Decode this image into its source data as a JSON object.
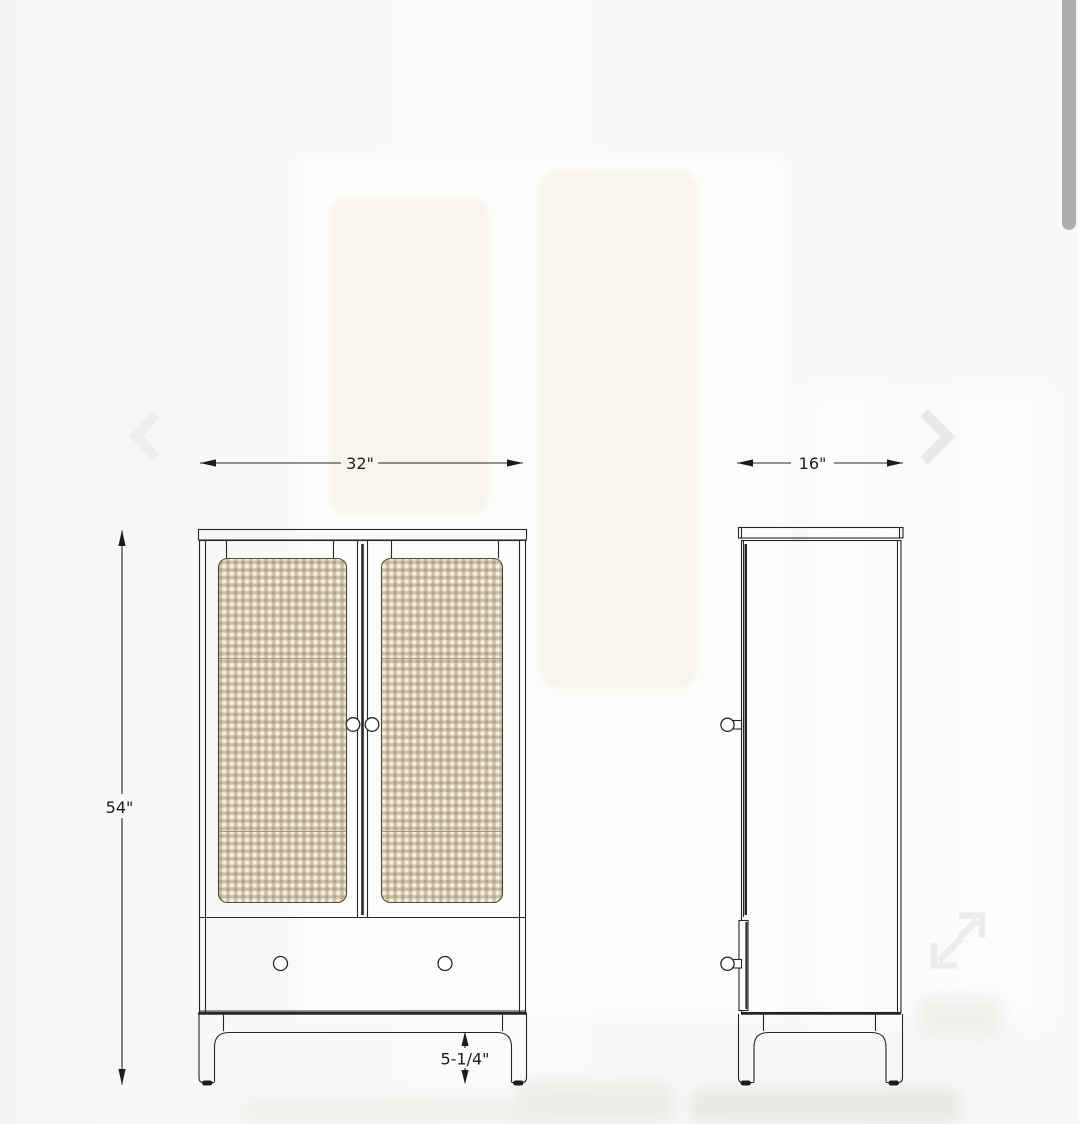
{
  "viewer": {
    "controls": {
      "prev_icon": "chevron-left",
      "next_icon": "chevron-right",
      "expand_icon": "expand-arrows",
      "scrollbar_color": "#aeaeae",
      "control_gray": "#ececec"
    }
  },
  "diagram": {
    "labels": {
      "width": "32\"",
      "depth": "16\"",
      "height": "54\"",
      "leg_clearance": "5-1/4\""
    },
    "colors": {
      "line": "#262626",
      "line_heavy": "#1e1e1e",
      "cane_base": "#c9bda4",
      "cane_light": "#d7ccb4",
      "cane_dot": "#f6f0dd",
      "cane_cross": "#b0a489",
      "panel_stroke": "#4d4a3e",
      "seam": "#a2957a"
    }
  }
}
